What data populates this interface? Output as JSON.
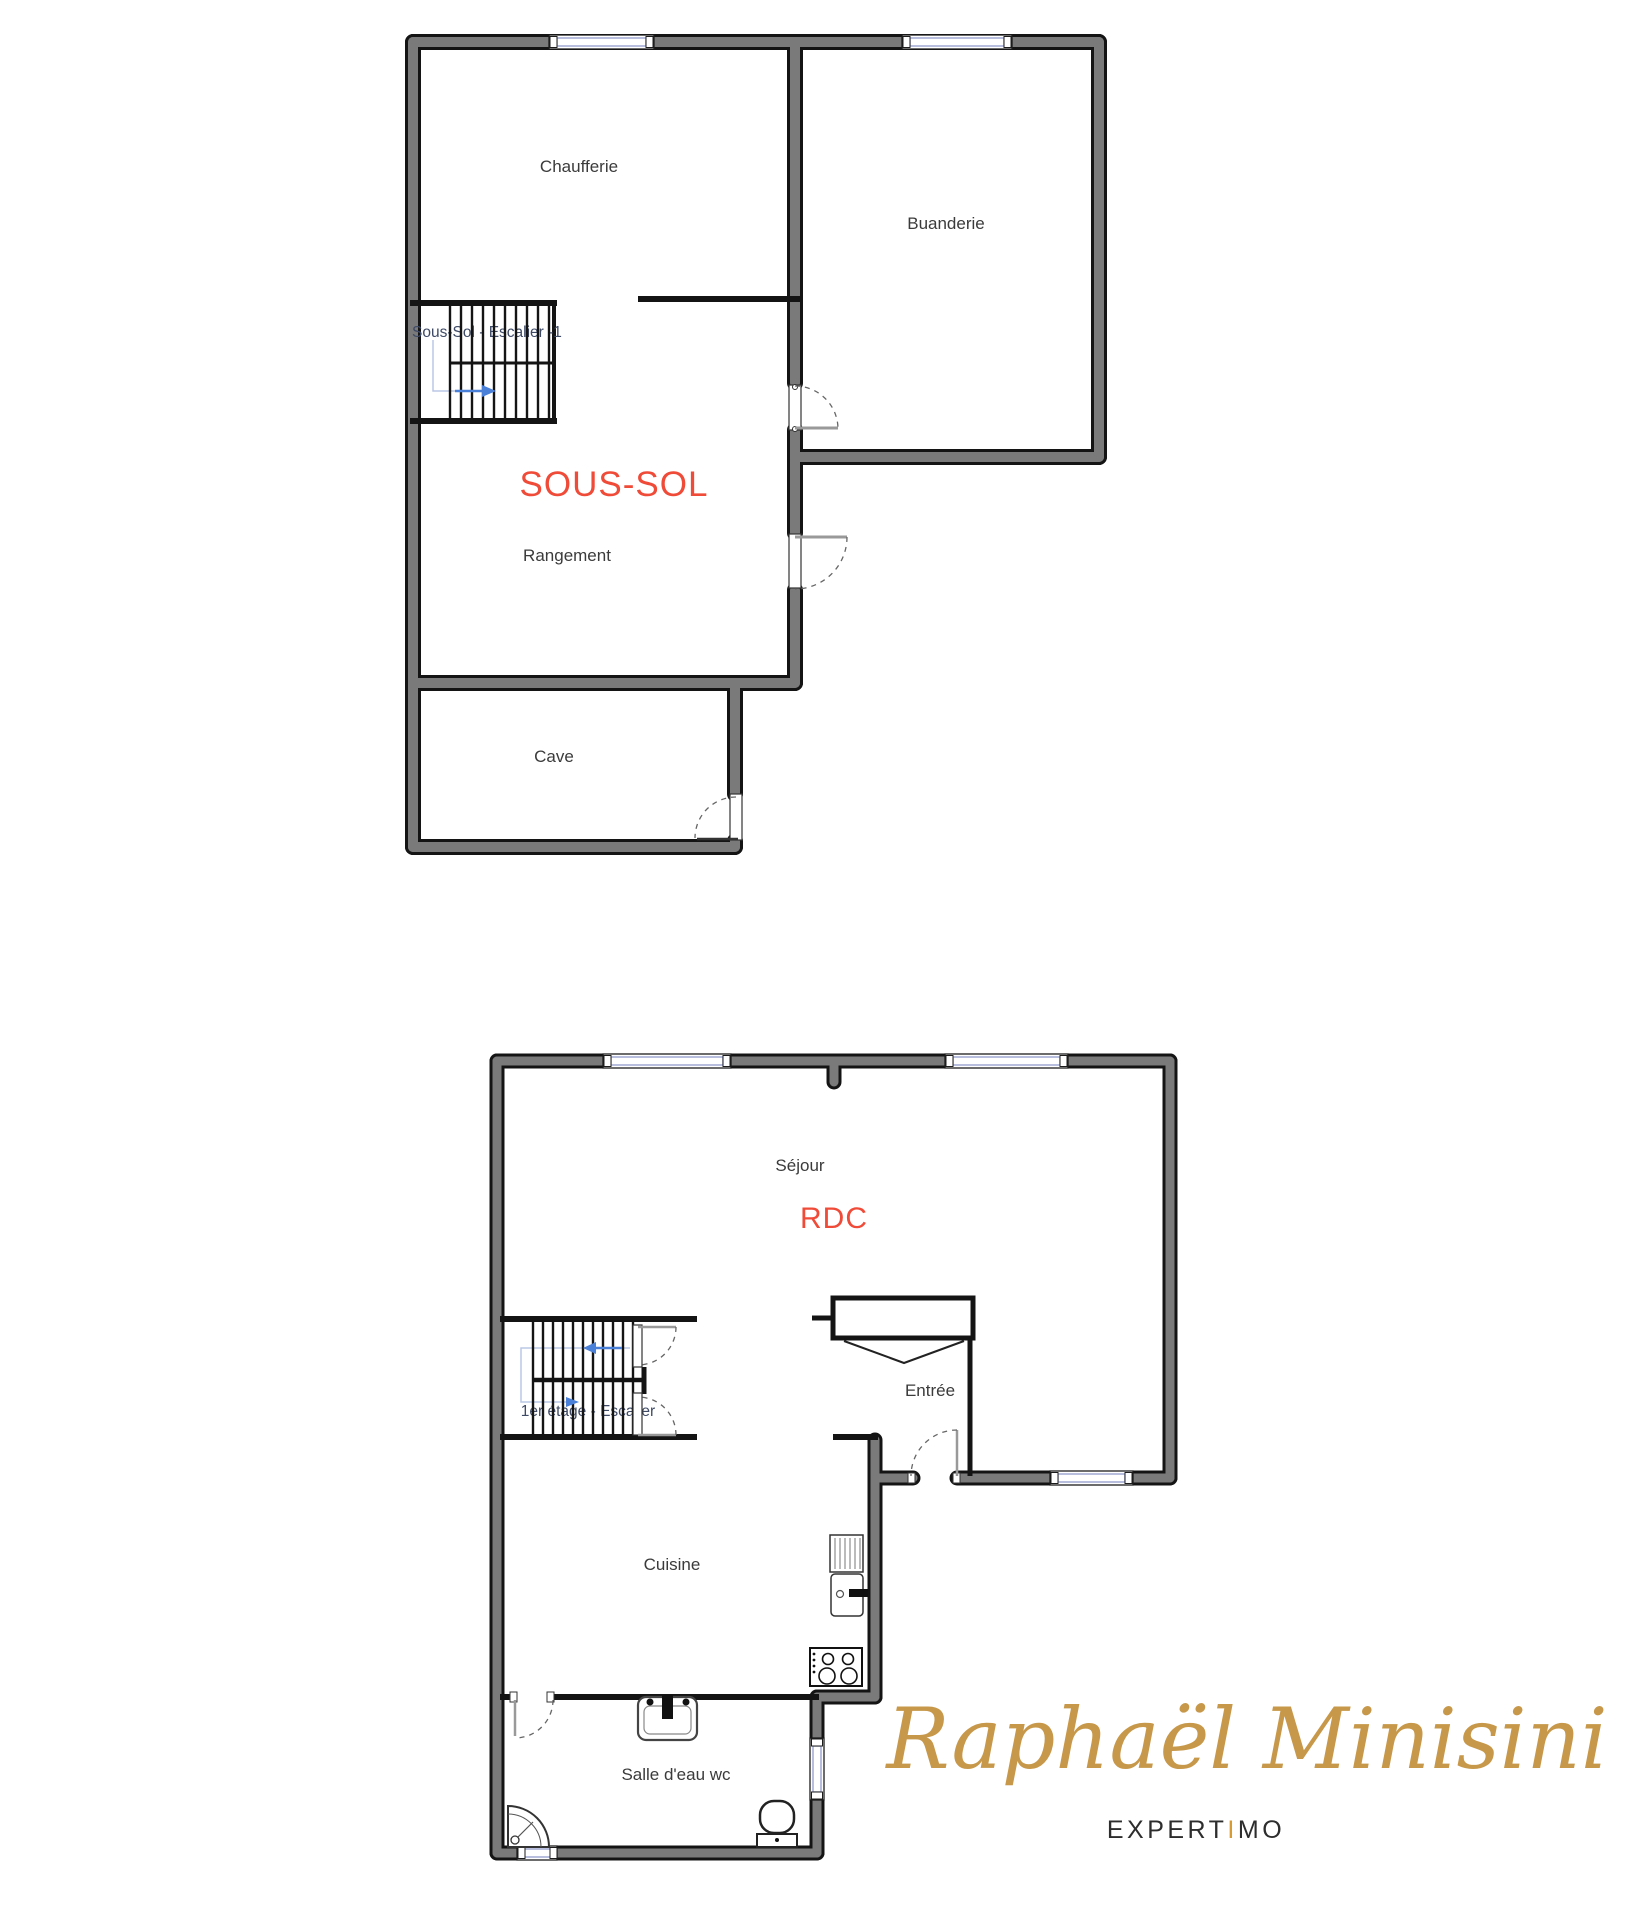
{
  "floors": {
    "basement": {
      "title": "SOUS-SOL",
      "stair_label": "Sous-Sol - Escalier -1",
      "rooms": [
        {
          "name": "Chaufferie"
        },
        {
          "name": "Buanderie"
        },
        {
          "name": "Rangement"
        },
        {
          "name": "Cave"
        }
      ]
    },
    "ground": {
      "title": "RDC",
      "stair_label": "1er étage - Escalier",
      "rooms": [
        {
          "name": "Séjour"
        },
        {
          "name": "Entrée"
        },
        {
          "name": "Cuisine"
        },
        {
          "name": "Salle d'eau wc"
        }
      ]
    }
  },
  "branding": {
    "agent_name": "Raphaël Minisini",
    "brand_first": "EXPERT",
    "brand_accent": "I",
    "brand_last": "MO",
    "accent_gold": "#c7984a",
    "floor_label_red": "#f04b38"
  }
}
